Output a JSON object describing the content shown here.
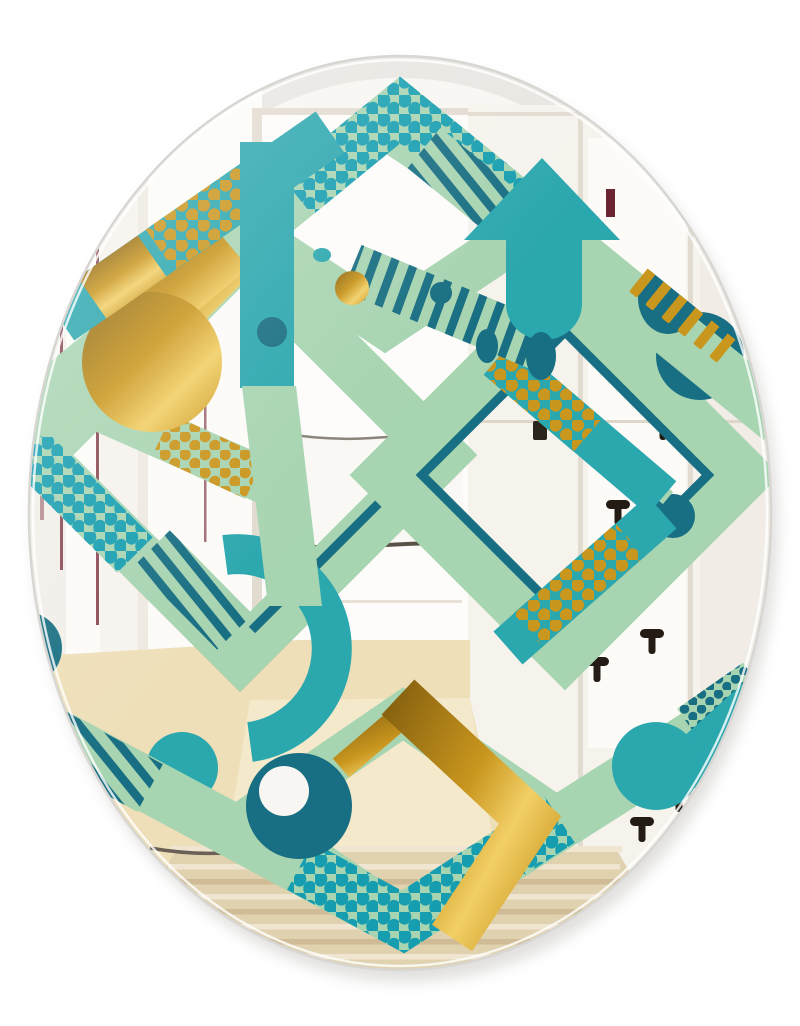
{
  "scene": {
    "type": "product-photo",
    "subject": "Oval frameless wall mirror with retro geometric mint, teal and gold pattern, reflecting a white hallway with doors, wood floor and a woven rug",
    "background": "#ffffff"
  },
  "palette": {
    "mint": "#a7d4b1",
    "teal": "#2ba7ae",
    "teal_dot": "#169eb0",
    "dark_teal": "#186e82",
    "gold": "#c9961e",
    "gold_dark": "#8a6410",
    "gold_light": "#f2cf66",
    "glass": "#f8f6f2",
    "wall": "#f6f3ed",
    "wall_far": "#f1ede6",
    "ceiling": "#e8e6e1",
    "door": "#fcfbf8",
    "frame": "#e2dbd0",
    "accent_line": "#8c4a55",
    "squiggle": "#5a5248",
    "floor": "#eedfb8",
    "floor_light": "#f6ecd2",
    "rug_base": "#e0d1af",
    "rug_dark": "#cfbc96",
    "rug_light": "#efe5d0",
    "rug_edge": "#6a6055",
    "hook": "#241c14",
    "plate": "#6b2430",
    "latch": "#2b241d",
    "rim": "#d8d6d2",
    "shadow": "#c9c7c3"
  },
  "mirror": {
    "shape": "oval",
    "cx": 400,
    "cy": 513,
    "rx": 371,
    "ry": 457
  },
  "reflection": {
    "hooks": [
      {
        "x": 663,
        "y": 420
      },
      {
        "x": 618,
        "y": 505
      },
      {
        "x": 652,
        "y": 634
      },
      {
        "x": 597,
        "y": 662
      },
      {
        "x": 679,
        "y": 792
      },
      {
        "x": 642,
        "y": 822
      }
    ],
    "strike_plate": {
      "x": 606,
      "y": 189
    },
    "latch": {
      "x": 533,
      "y": 421
    },
    "rug": {
      "stripe_count": 9
    }
  },
  "pattern": {
    "motifs": [
      "hexagon-chevron-arms",
      "diamond-rings",
      "up-arrow",
      "gold-chevron-arrow",
      "polka-dots",
      "diagonal-stripes",
      "gold-ribbons",
      "circles"
    ]
  }
}
